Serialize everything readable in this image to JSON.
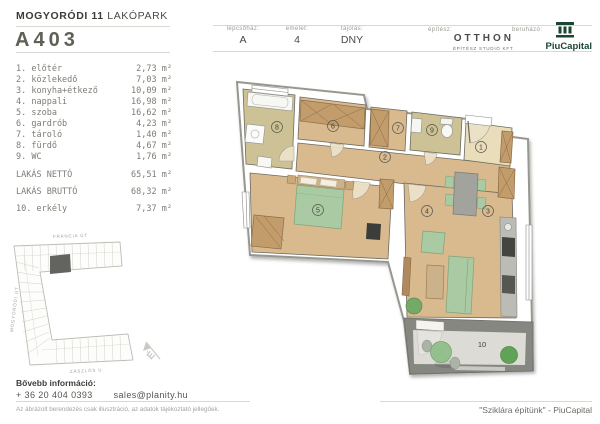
{
  "header": {
    "project_bold": "MOGYORÓDI 11",
    "project_light": "LAKÓPARK",
    "unit": "A403",
    "info": [
      {
        "label": "lépcsőház:",
        "value": "A"
      },
      {
        "label": "emelet:",
        "value": "4"
      },
      {
        "label": "tájolás:",
        "value": "DNY"
      }
    ],
    "architect_label": "építész:",
    "architect_name": "OTTHON",
    "architect_sub": "ÉPÍTÉSZ STUDIÓ KFT.",
    "developer_label": "beruházó:",
    "developer_name": "PiuCapital"
  },
  "rooms": [
    {
      "label": "1. előtér",
      "area": "2,73 m²"
    },
    {
      "label": "2. közlekedő",
      "area": "7,03 m²"
    },
    {
      "label": "3. konyha+étkező",
      "area": "10,09 m²"
    },
    {
      "label": "4. nappali",
      "area": "16,98 m²"
    },
    {
      "label": "5. szoba",
      "area": "16,62 m²"
    },
    {
      "label": "6. gardrób",
      "area": "4,23 m²"
    },
    {
      "label": "7. tároló",
      "area": "1,40 m²"
    },
    {
      "label": "8. fürdő",
      "area": "4,67 m²"
    },
    {
      "label": "9. WC",
      "area": "1,76 m²"
    }
  ],
  "totals": [
    {
      "label": "LAKÁS NETTÓ",
      "area": "65,51 m²"
    },
    {
      "label": "LAKÁS BRUTTÓ",
      "area": "68,32 m²"
    }
  ],
  "balcony_row": {
    "label": "10. erkély",
    "area": "7,37 m²"
  },
  "plan": {
    "labels": [
      "1",
      "2",
      "3",
      "4",
      "5",
      "6",
      "7",
      "8",
      "9",
      "10"
    ]
  },
  "site": {
    "street_top": "FRANCIA ÚT",
    "street_left": "MOGYORÓDI ÚT",
    "street_bottom": "ZÁSZLÓS U.",
    "compass": "É"
  },
  "footer": {
    "info_label": "Bővebb információ:",
    "phone": "+ 36 20 404 0393",
    "email": "sales@planity.hu",
    "disclaimer": "Az ábrázolt berendezés csak illusztráció, az adatok tájékoztató jellegűek.",
    "slogan": "\"Sziklára építünk\" - PiuCapital"
  },
  "colors": {
    "floor_tan": "#d9b98e",
    "floor_light": "#e9ddbb",
    "floor_olive": "#cdc295",
    "furniture_green": "#a9caa2",
    "wood": "#c39c6b",
    "brand_green": "#1a4632"
  }
}
